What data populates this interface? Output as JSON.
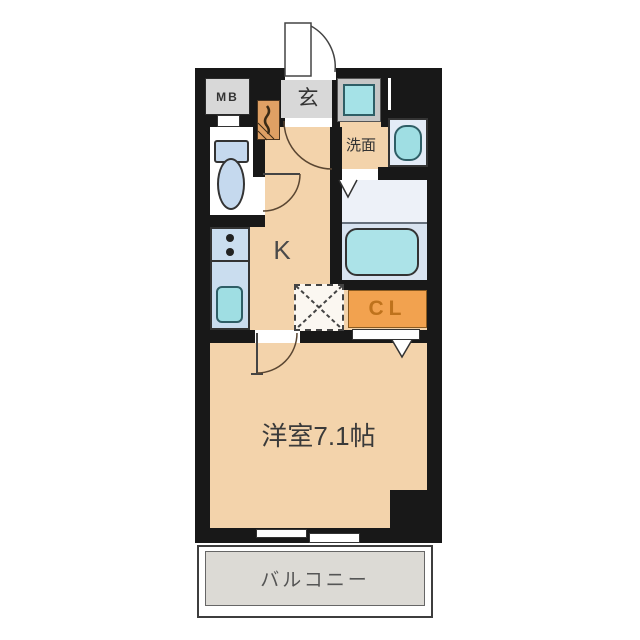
{
  "floorplan": {
    "type": "japanese-apartment-1k",
    "labels": {
      "meter_box": "MB",
      "entrance": "玄",
      "washroom": "洗面",
      "kitchen": "K",
      "closet": "CL",
      "main_room": "洋室7.1帖",
      "balcony": "バルコニー"
    },
    "rooms": [
      {
        "name": "entrance-genkan",
        "label": "玄"
      },
      {
        "name": "meter-box",
        "label": "MB"
      },
      {
        "name": "toilet",
        "label": ""
      },
      {
        "name": "washroom",
        "label": "洗面"
      },
      {
        "name": "bathroom",
        "label": ""
      },
      {
        "name": "kitchen",
        "label": "K"
      },
      {
        "name": "closet",
        "label": "CL"
      },
      {
        "name": "western-room-7.1-tatami",
        "label": "洋室7.1帖"
      },
      {
        "name": "balcony",
        "label": "バルコニー"
      }
    ],
    "colors": {
      "wall": "#181818",
      "floor": "#F3D3AB",
      "entrance_gray": "#D8D8D8",
      "balcony_gray": "#DCDAD5",
      "fixture_cyan": "#9FDEE3",
      "fixture_blue": "#C5D9EE",
      "bath_floor_upper": "#EDF1F8",
      "bath_floor_lower": "#D8E3F0",
      "closet_orange": "#F2A24F",
      "closet_text": "#BE721C",
      "shoe_cabinet_orange": "#DFA064"
    }
  }
}
